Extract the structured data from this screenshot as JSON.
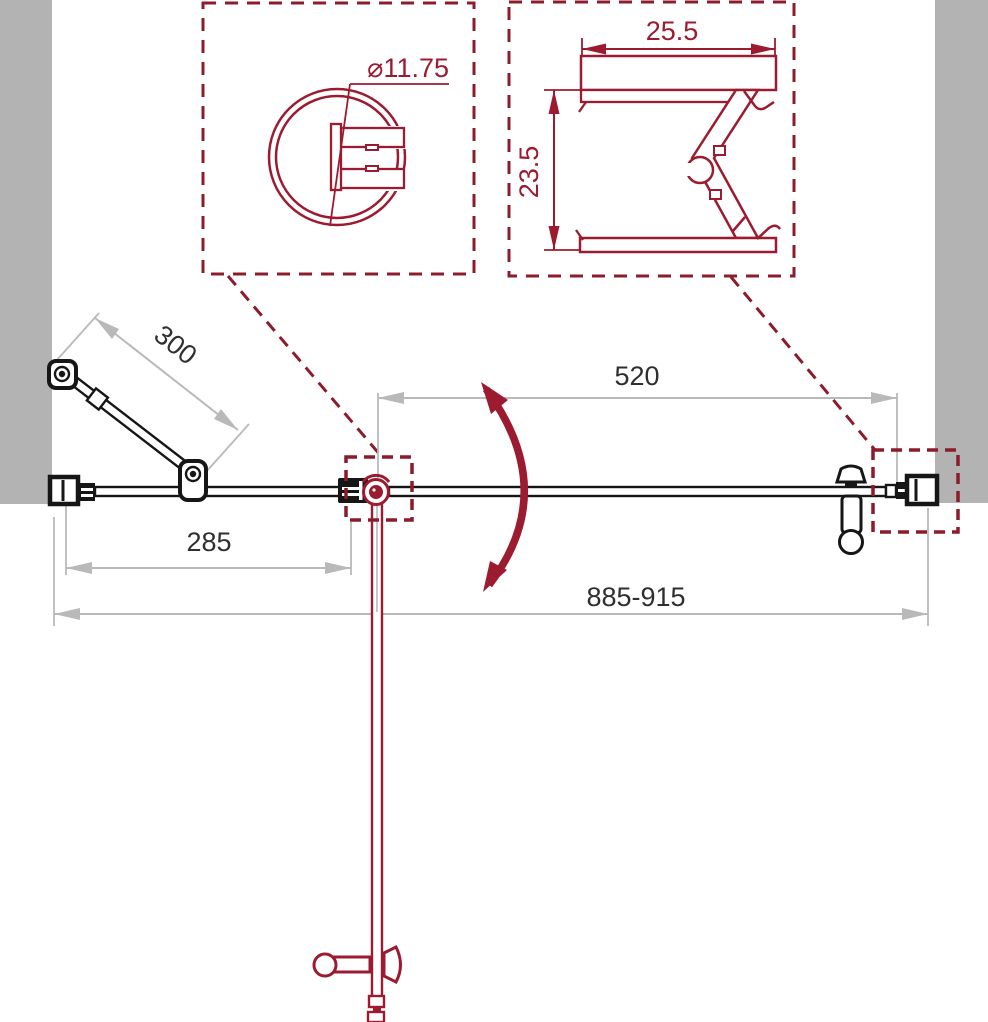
{
  "drawing_title": "shower-door-technical-drawing",
  "dimensions": {
    "door_width": "520",
    "fixed_panel_width": "285",
    "overall_width": "885-915",
    "support_bar_length": "300",
    "knob_profile_diameter": "⌀11.75",
    "wall_profile_width": "25.5",
    "wall_profile_depth": "23.5"
  },
  "colors": {
    "red": "#9c1b30",
    "dash": "#8c1c2b",
    "wall": "#b3b3b3",
    "dim": "#b9b9b9",
    "ink": "#161616",
    "txt": "#2f2f2f"
  }
}
